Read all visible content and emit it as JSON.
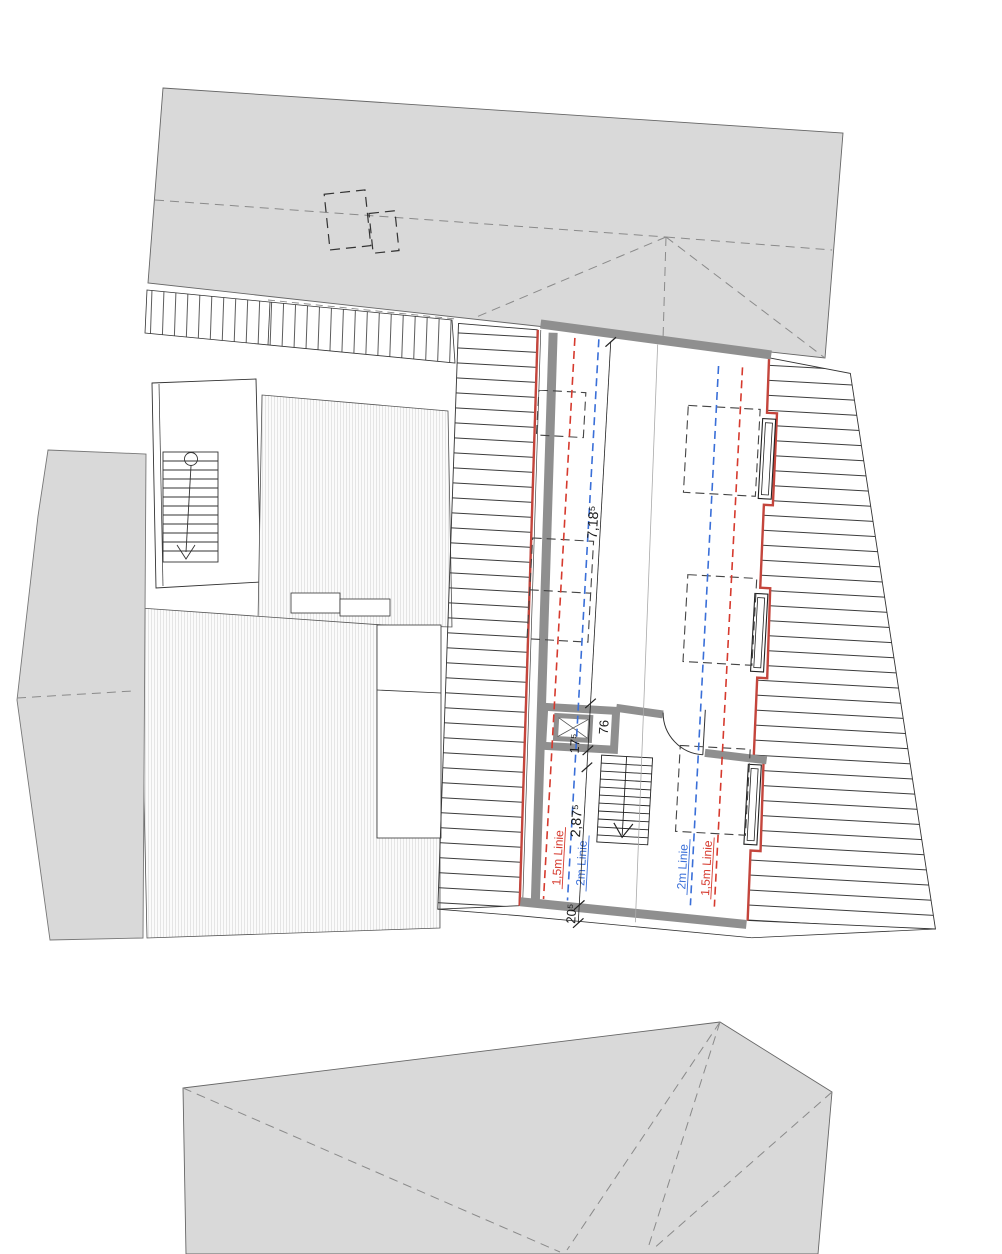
{
  "plan": {
    "dimensions": {
      "length_718": "7,18⁵",
      "chimney_76": "76",
      "seg_175": "17⁵",
      "width_287": "2,87⁵",
      "wall_205": "20⁵"
    },
    "height_lines": {
      "left_red": "1,5m Linie",
      "left_blue": "2m Linie",
      "right_blue": "2m Linie",
      "right_red": "1,5m Linie"
    },
    "colors": {
      "line_red": "#d63a2e",
      "line_blue": "#3a6fd8",
      "wall_gray": "#8f8f8f",
      "building_fill": "#d9d9d9",
      "accent_wall_red": "#c4453c"
    }
  }
}
